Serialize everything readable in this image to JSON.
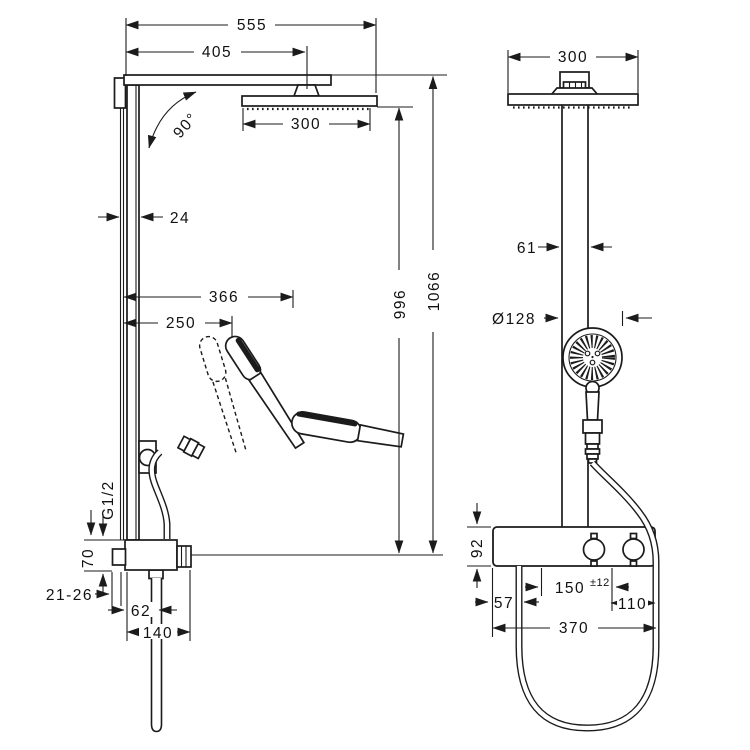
{
  "figure": {
    "background": "#ffffff",
    "line_color": "#1b1b1b",
    "side_view": {
      "dim_total_width": "555",
      "dim_arm_length": "405",
      "dim_overhead_width": "300",
      "dim_swivel_angle": "90°",
      "dim_bar_depth": "24",
      "dim_handshower_reach": "366",
      "dim_holder_reach": "250",
      "dim_height_to_overhead": "996",
      "dim_height_to_arm": "1066",
      "dim_thread": "G1/2",
      "dim_valve_height": "70",
      "dim_wall_clearance": "21-26",
      "dim_outlet_offset": "62",
      "dim_valve_depth": "140"
    },
    "front_view": {
      "dim_overhead_width": "300",
      "dim_pipe_width": "61",
      "dim_handshower_diameter": "Ø128",
      "dim_valve_height": "92",
      "dim_hose_offset": "57",
      "dim_inlet_spacing": "150",
      "dim_inlet_spacing_tolerance": "±12",
      "dim_inlet_edge_offset": "110",
      "dim_valve_width": "370"
    }
  }
}
